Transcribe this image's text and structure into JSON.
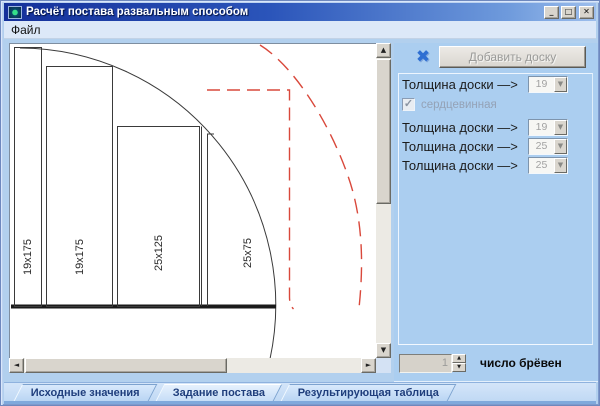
{
  "window": {
    "title": "Расчёт постава развальным способом"
  },
  "glyphs": {
    "minimize": "_",
    "maximize": "□",
    "close": "✕",
    "delete": "✖",
    "dropdown": "▼",
    "check": "✓",
    "spin_up": "▲",
    "spin_down": "▼",
    "scroll_up": "▲",
    "scroll_down": "▼",
    "scroll_left": "◄",
    "scroll_right": "►"
  },
  "menu": {
    "file": "Файл"
  },
  "toolbar": {
    "add_board": "Добавить доску"
  },
  "panel": {
    "rows": [
      {
        "label": "Толщина доски —>",
        "value": "19"
      },
      {
        "label": "Толщина доски —>",
        "value": "19"
      },
      {
        "label": "Толщина доски —>",
        "value": "25"
      },
      {
        "label": "Толщина доски —>",
        "value": "25"
      }
    ],
    "core_checkbox": {
      "label": "сердцевинная",
      "checked": true
    },
    "log_count": {
      "value": "1",
      "label": "число брёвен"
    }
  },
  "tabs": [
    {
      "label": "Исходные значения",
      "active": false
    },
    {
      "label": "Задание постава",
      "active": true
    },
    {
      "label": "Результирующая таблица",
      "active": false
    }
  ],
  "diagram": {
    "board_labels": [
      "19x175",
      "19x175",
      "25x125",
      "25x75"
    ],
    "colors": {
      "outline": "#3A3A3A",
      "baseline": "#1A1A1A",
      "dashed": "#D9483B",
      "canvas": "#FFFFFF"
    }
  },
  "colors": {
    "titlebar_start": "#14309A",
    "titlebar_end": "#9DBEEC",
    "client_bg": "#B2D0EE",
    "panel_bg": "#ABCEF0",
    "tab_text": "#1F3E7C"
  }
}
